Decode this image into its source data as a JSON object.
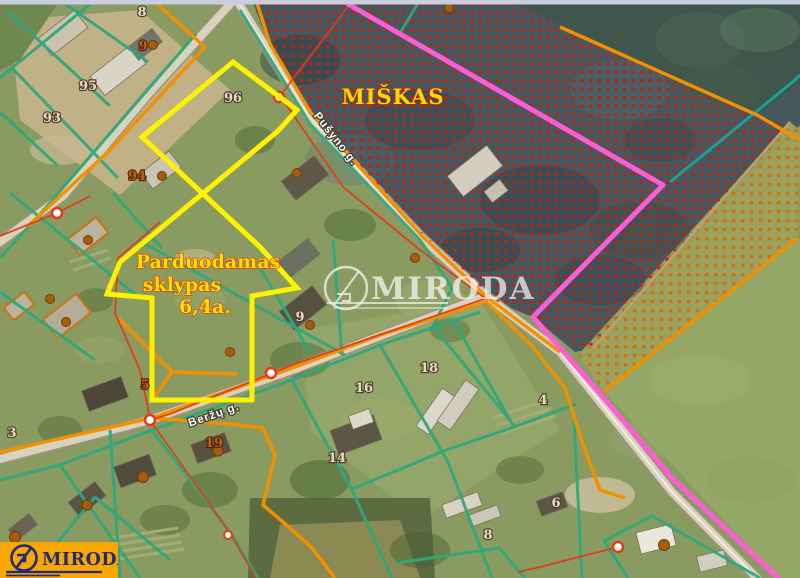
{
  "map": {
    "region_label": "MIŠKAS",
    "sale_notice": {
      "line1": "Parduodamas",
      "line2": "sklypas",
      "line3": "6,4a."
    },
    "watermark": {
      "text": "MIRODA"
    },
    "logo": {
      "text": "MIRODA"
    },
    "streets": [
      {
        "name": "Beržų g.",
        "x": 215,
        "y": 418,
        "rot": -19
      },
      {
        "name": "Pušyno g.",
        "x": 333,
        "y": 141,
        "rot": 52
      }
    ],
    "parcels": [
      {
        "num": "8",
        "x": 142,
        "y": 16,
        "tone": "pale"
      },
      {
        "num": "9",
        "x": 143,
        "y": 50,
        "tone": "brown"
      },
      {
        "num": "95",
        "x": 88,
        "y": 90,
        "tone": "pale"
      },
      {
        "num": "93",
        "x": 52,
        "y": 122,
        "tone": "pale"
      },
      {
        "num": "96",
        "x": 233,
        "y": 102,
        "tone": "pale"
      },
      {
        "num": "94",
        "x": 137,
        "y": 180,
        "tone": "brown"
      },
      {
        "num": "9",
        "x": 300,
        "y": 321,
        "tone": "pale"
      },
      {
        "num": "5",
        "x": 145,
        "y": 389,
        "tone": "brown"
      },
      {
        "num": "3",
        "x": 12,
        "y": 437,
        "tone": "pale"
      },
      {
        "num": "19",
        "x": 214,
        "y": 447,
        "tone": "brown"
      },
      {
        "num": "18",
        "x": 429,
        "y": 372,
        "tone": "pale"
      },
      {
        "num": "16",
        "x": 364,
        "y": 392,
        "tone": "pale"
      },
      {
        "num": "14",
        "x": 337,
        "y": 462,
        "tone": "pale"
      },
      {
        "num": "4",
        "x": 543,
        "y": 404,
        "tone": "pale"
      },
      {
        "num": "6",
        "x": 556,
        "y": 507,
        "tone": "pale"
      },
      {
        "num": "8",
        "x": 488,
        "y": 539,
        "tone": "pale"
      }
    ],
    "colors": {
      "plot_outline": "#fff200",
      "parcel_line_teal": "#2fa87c",
      "boundary_orange": "#f29100",
      "boundary_pink": "#ff5cd6",
      "boundary_red": "#e23b18",
      "forest_dot_red": "#c41f10",
      "logo_background": "#f7a700",
      "logo_navy": "#232a7e",
      "label_yellow": "#ffe000"
    }
  }
}
